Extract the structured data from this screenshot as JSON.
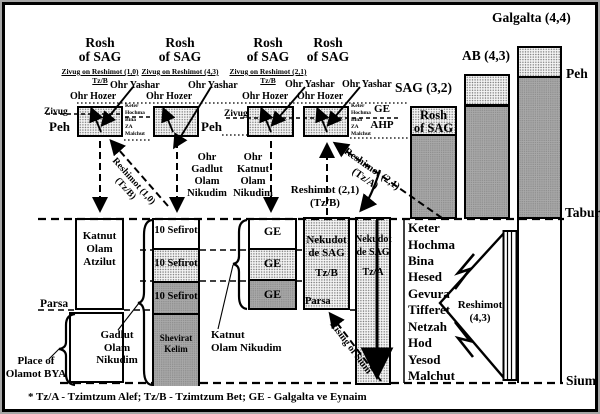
{
  "top_labels": {
    "galgalta": "Galgalta (4,4)",
    "ab": "AB (4,3)",
    "sag": "SAG (3,2)",
    "peh_right": "Peh",
    "tabur": "Tabur",
    "sium": "Sium"
  },
  "rosh_boxes": [
    {
      "t1": "Rosh",
      "t2": "of SAG",
      "sub1": "Zivug on Reshimot (1,0)",
      "sub2": "Tz/B",
      "yashar": "Ohr Yashar",
      "hozer": "Ohr Hozer"
    },
    {
      "t1": "Rosh",
      "t2": "of SAG",
      "sub1": "Zivug on Reshimot (4,3)",
      "sub2": "",
      "yashar": "Ohr Yashar",
      "hozer": "Ohr Hozer"
    },
    {
      "t1": "Rosh",
      "t2": "of SAG",
      "sub1": "Zivug on Reshimot (2,1)",
      "sub2": "Tz/B",
      "yashar": "Ohr Yashar",
      "hozer": "Ohr Hozer"
    },
    {
      "t1": "Rosh",
      "t2": "of SAG",
      "sub1": "",
      "sub2": "",
      "yashar": "Ohr Yashar",
      "hozer": "Ohr Hozer"
    }
  ],
  "sag_column": {
    "rosh1": "Rosh",
    "rosh2": "of SAG"
  },
  "peh_zivug": {
    "zivug1": "Zivug",
    "peh1": "Peh",
    "peh2": "Peh",
    "zivug2": "Zivug"
  },
  "mini_sefirot": [
    "Keter",
    "Hochma",
    "Bina",
    "ZA",
    "Malchut"
  ],
  "ge_ahp": {
    "ge": "GE",
    "ahp": "AHP"
  },
  "flow": {
    "reshimot10_l1": "Reshimot (1,0)",
    "reshimot10_l2": "(Tz/B)",
    "ohr_gadlut": [
      "Ohr",
      "Gadlut",
      "Olam",
      "Nikudim"
    ],
    "ohr_katnut": [
      "Ohr",
      "Katnut",
      "Olam",
      "Nikudim"
    ],
    "reshimot21b_l1": "Reshimot (2,1)",
    "reshimot21b_l2": "(Tz/B)",
    "reshimot21a_l1": "Reshimot (2,1)",
    "reshimot21a_l2": "(Tz/A)",
    "rising": "Rising of Sium"
  },
  "left_column": {
    "katnut_atzilut": [
      "Katnut",
      "Olam",
      "Atzilut"
    ],
    "parsa": "Parsa"
  },
  "labels": {
    "gadlut": [
      "Gadlut",
      "Olam",
      "Nikudim"
    ],
    "katnut_nikudim": [
      "Katnut",
      "Olam Nikudim"
    ],
    "place_bya": [
      "Place of",
      "Olamot BYA"
    ]
  },
  "sefirot10_column": {
    "s1": "10 Sefirot",
    "s2": "10 Sefirot",
    "s3": "10 Sefirot",
    "shevirat": [
      "Shevirat",
      "Kelim"
    ]
  },
  "ge_column": {
    "s1": "GE",
    "s2": "GE",
    "s3": "GE"
  },
  "nekudot_b": {
    "l1": "Nekudot",
    "l2": "de SAG",
    "l3": "Tz/B",
    "parsa": "Parsa"
  },
  "nekudot_a": {
    "l1": "Nekudot",
    "l2": "de SAG",
    "l3": "Tz/A"
  },
  "sefirot_list": [
    "Keter",
    "Hochma",
    "Bina",
    "Hesed",
    "Gevura",
    "Tifferet",
    "Netzah",
    "Hod",
    "Yesod",
    "Malchut"
  ],
  "reshimot_arrow": {
    "l1": "Reshimot",
    "l2": "(4,3)"
  },
  "footnote": "* Tz/A - Tzimtzum Alef; Tz/B - Tzimtzum Bet; GE - Galgalta ve Eynaim",
  "colors": {
    "gray": "#a9a9a9",
    "stipple_bg": "#f4f4f4",
    "line": "#000000"
  }
}
